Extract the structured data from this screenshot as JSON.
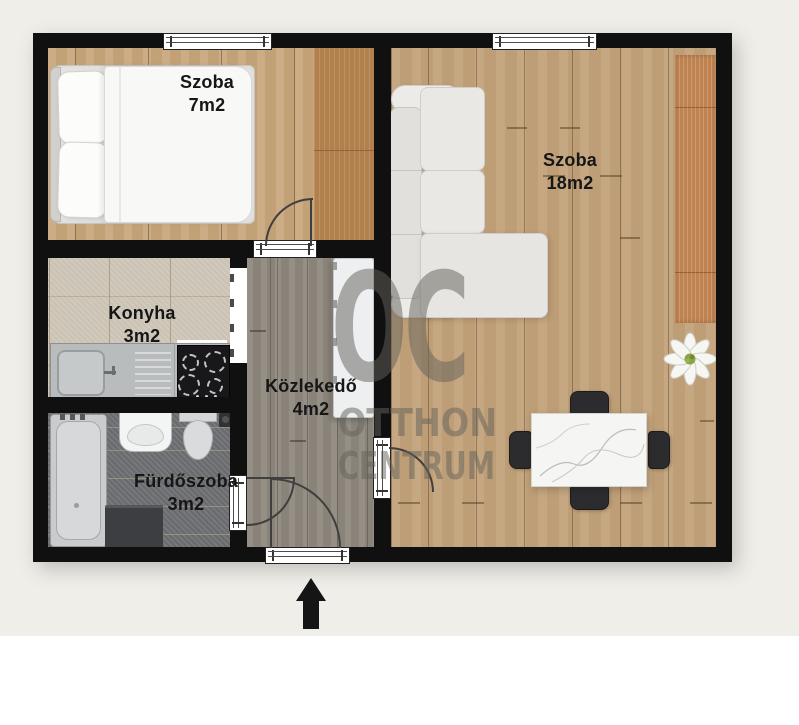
{
  "floorplan": {
    "rooms": [
      {
        "id": "bedroom",
        "name": "Szoba",
        "area": "7m2"
      },
      {
        "id": "living",
        "name": "Szoba",
        "area": "18m2"
      },
      {
        "id": "kitchen",
        "name": "Konyha",
        "area": "3m2"
      },
      {
        "id": "hallway",
        "name": "Közlekedő",
        "area": "4m2"
      },
      {
        "id": "bathroom",
        "name": "Fürdőszoba",
        "area": "3m2"
      }
    ],
    "watermark": {
      "logo_text": "OC",
      "line1": "OTTHON",
      "line2": "CENTRUM"
    },
    "entrance_marker": "up-arrow",
    "colors": {
      "wall": "#101010",
      "background_upper": "#efeee9",
      "background_lower": "#ffffff",
      "wood_bedroom": "#c8a77d",
      "wood_living": "#c2a27a",
      "wood_wardrobe": "#b1804d",
      "wood_runner": "#bf8351",
      "floor_hall": "#8f8980",
      "floor_kitchen": "#cfc7b9",
      "floor_bathroom": "#6f7175",
      "watermark_gray": "#64625c"
    }
  }
}
